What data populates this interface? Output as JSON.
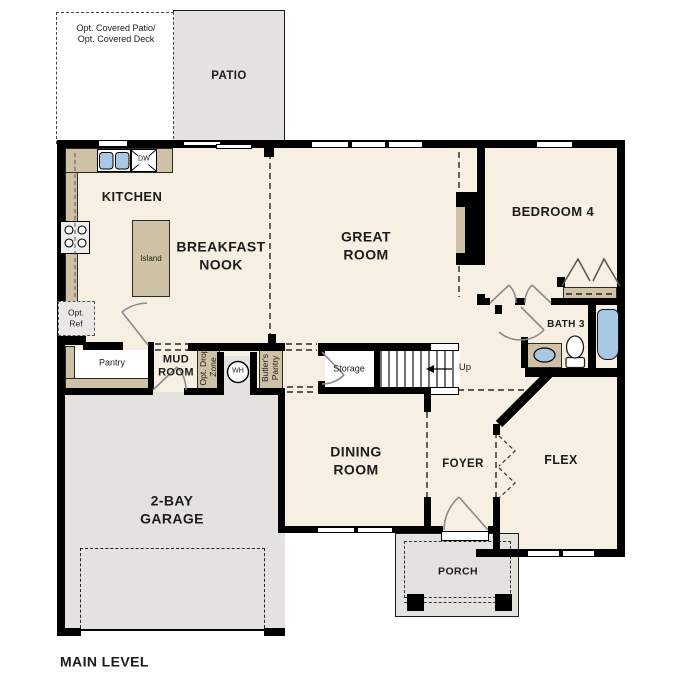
{
  "plan_title": "MAIN LEVEL",
  "colors": {
    "floor-cream": "#f7f0e2",
    "floor-gray": "#e3e2df",
    "counter-tan": "#cec1a5",
    "fixture-blue": "#a9c8e6",
    "wall-black": "#000000"
  },
  "rooms": {
    "patio": "PATIO",
    "kitchen": "KITCHEN",
    "breakfast_nook": "BREAKFAST\nNOOK",
    "great_room": "GREAT\nROOM",
    "bedroom_4": "BEDROOM 4",
    "bath_3": "BATH 3",
    "mud_room": "MUD\nROOM",
    "dining_room": "DINING\nROOM",
    "foyer": "FOYER",
    "flex": "FLEX",
    "garage": "2-BAY\nGARAGE",
    "porch": "PORCH",
    "storage": "Storage"
  },
  "features": {
    "opt_covered": "Opt. Covered Patio/\nOpt. Covered Deck",
    "opt_ref": "Opt.\nRef",
    "island": "Island",
    "pantry": "Pantry",
    "dishwasher": "DW",
    "water_heater": "WH",
    "opt_drop_zone": "Opt. Drop\nZone",
    "butlers_pantry": "Butler's\nPantry",
    "stairs_up": "Up"
  }
}
